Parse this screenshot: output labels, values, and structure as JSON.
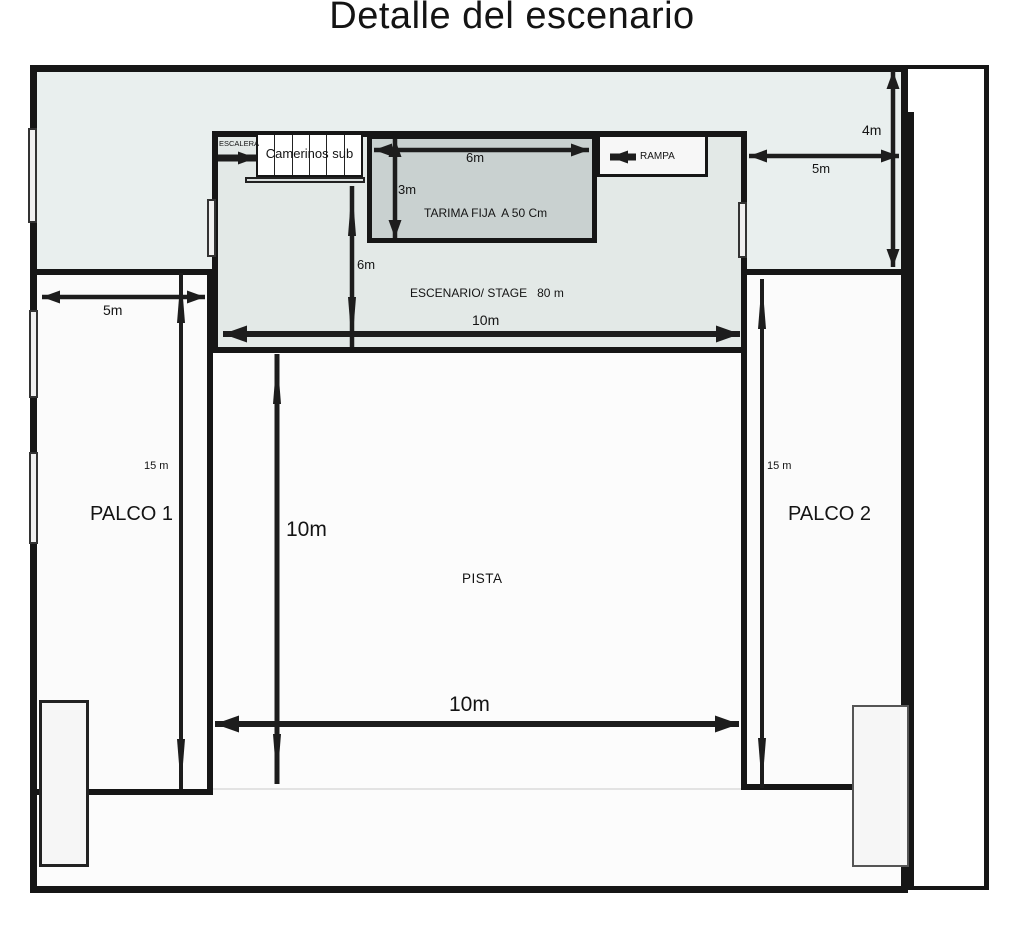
{
  "title": "Detalle del escenario",
  "stage": {
    "label": "ESCENARIO/ STAGE   80 m",
    "width_label": "10m",
    "depth_label": "6m",
    "tarima": {
      "label": "TARIMA FIJA  A 50 Cm",
      "width_label": "6m",
      "depth_label": "3m"
    },
    "camerinos": {
      "label": "Camerinos sub"
    },
    "escalera": {
      "label": "ESCALERA"
    },
    "rampa": {
      "label": "RAMPA"
    }
  },
  "right_area": {
    "width_label": "5m",
    "height_label": "4m"
  },
  "palco1": {
    "label": "PALCO 1",
    "width_label": "5m",
    "length_label": "15 m"
  },
  "palco2": {
    "label": "PALCO 2",
    "length_label": "15 m"
  },
  "pista": {
    "label": "PISTA",
    "width_label": "10m",
    "depth_label": "10m"
  },
  "colors": {
    "band": "#e9efee",
    "stage": "#e3e9e7",
    "tarima": "#c9d1d0",
    "outline": "#161616",
    "arrow": "#1d1d1d"
  }
}
